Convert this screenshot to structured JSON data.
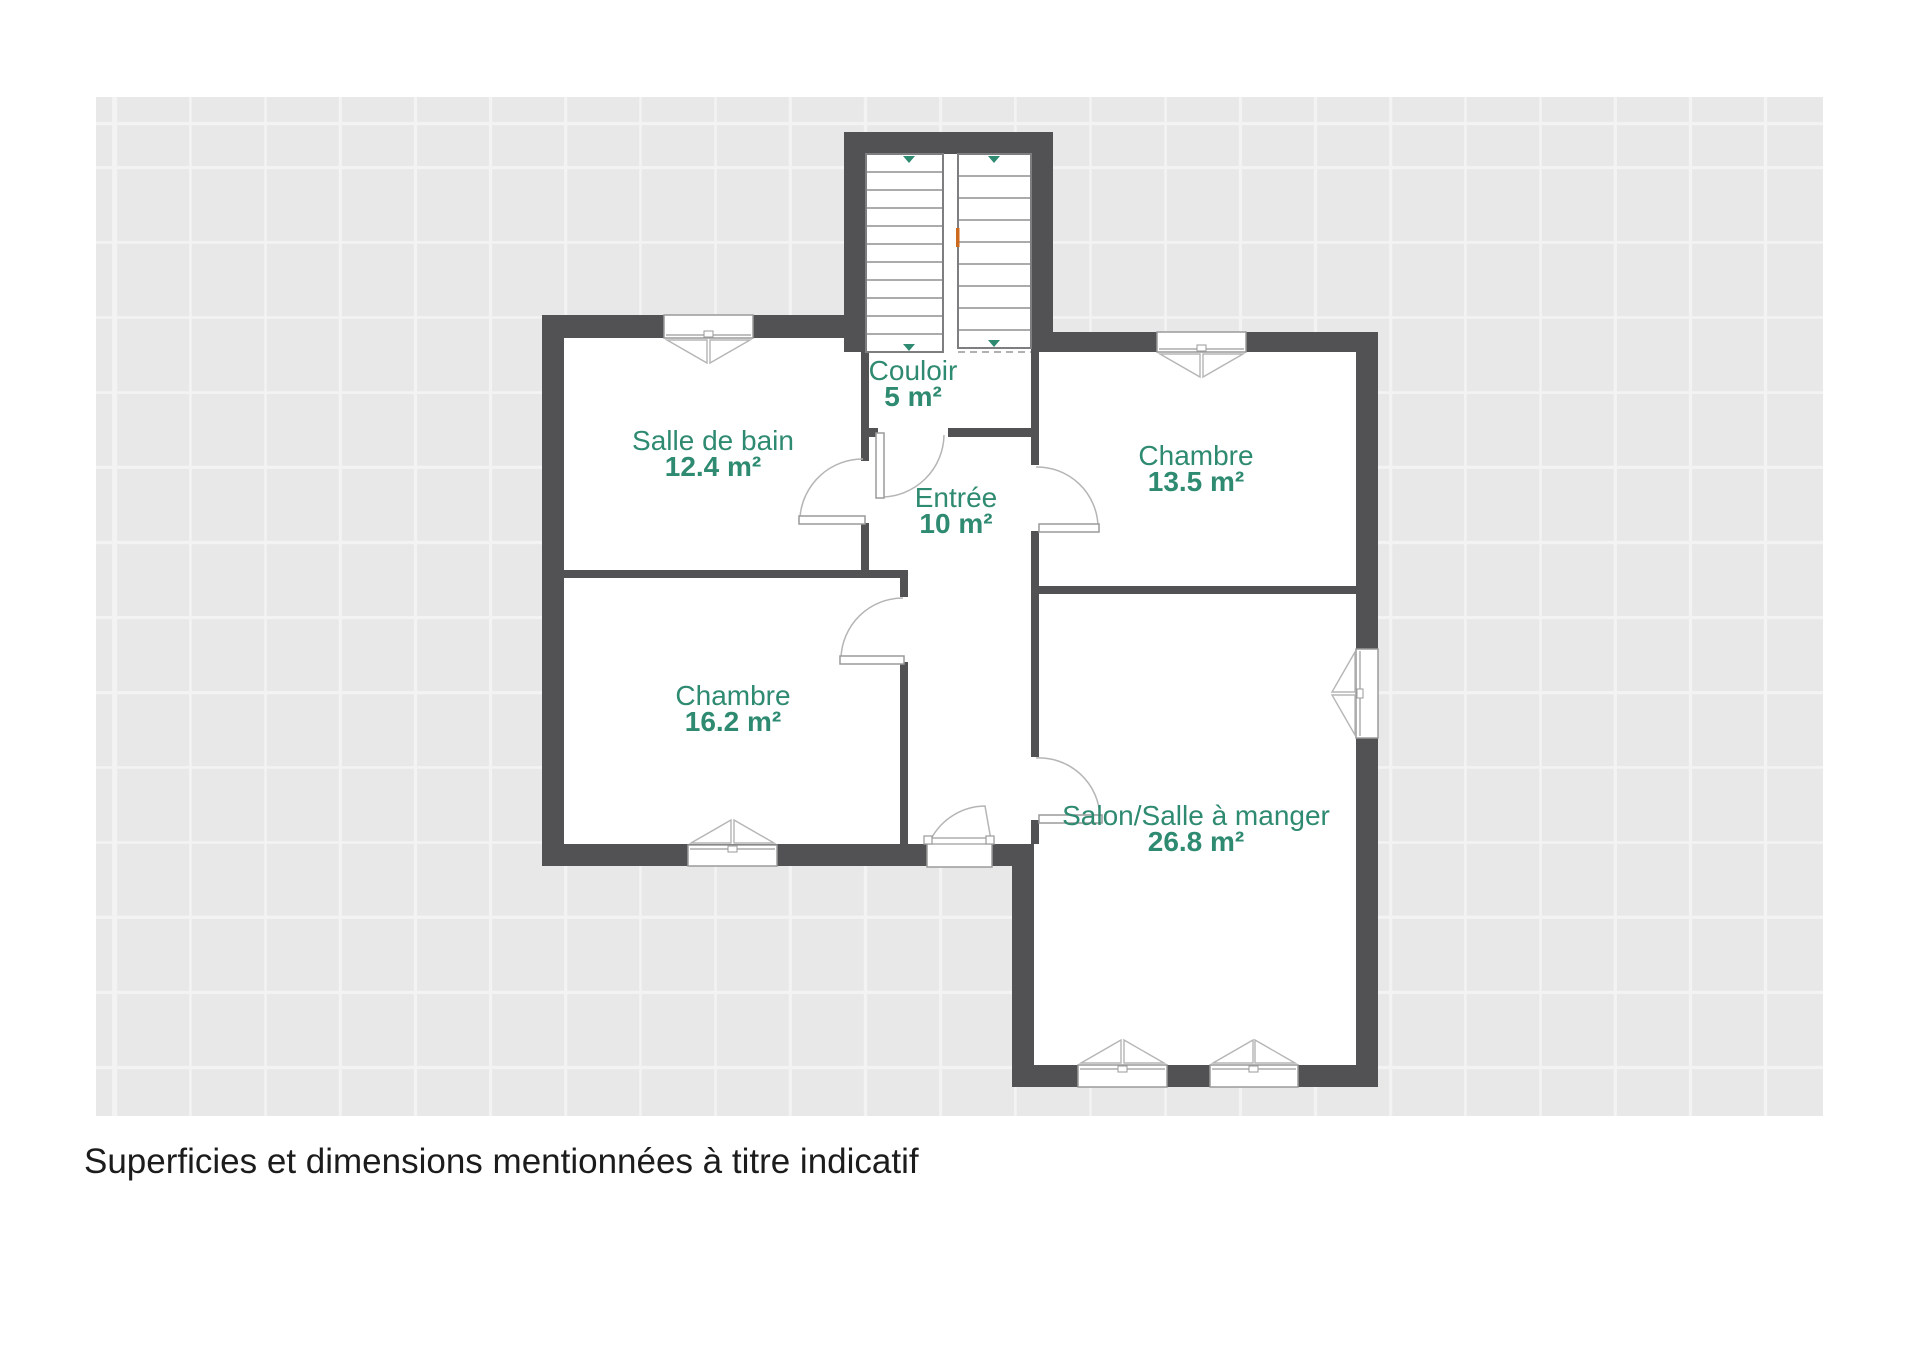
{
  "canvas": {
    "background": "#e8e8e8",
    "grid_line": "#f3f3f3"
  },
  "palette": {
    "wall": "#525255",
    "room_label_green": "#2e8a70",
    "stair_arrow_green": "#2e8a70",
    "orange_marker": "#cd6a1e",
    "door_swing_line": "#b5b5b5",
    "frame_line": "#9a9a9a",
    "caption_text": "#1c1c1c"
  },
  "rooms": [
    {
      "id": "couloir",
      "name": "Couloir",
      "area": "5 m²"
    },
    {
      "id": "salle-de-bain",
      "name": "Salle de bain",
      "area": "12.4 m²"
    },
    {
      "id": "chambre-13",
      "name": "Chambre",
      "area": "13.5 m²"
    },
    {
      "id": "entree",
      "name": "Entrée",
      "area": "10 m²"
    },
    {
      "id": "chambre-16",
      "name": "Chambre",
      "area": "16.2 m²"
    },
    {
      "id": "salon",
      "name": "Salon/Salle à manger",
      "area": "26.8 m²"
    }
  ],
  "caption": "Superficies et dimensions mentionnées à titre indicatif"
}
